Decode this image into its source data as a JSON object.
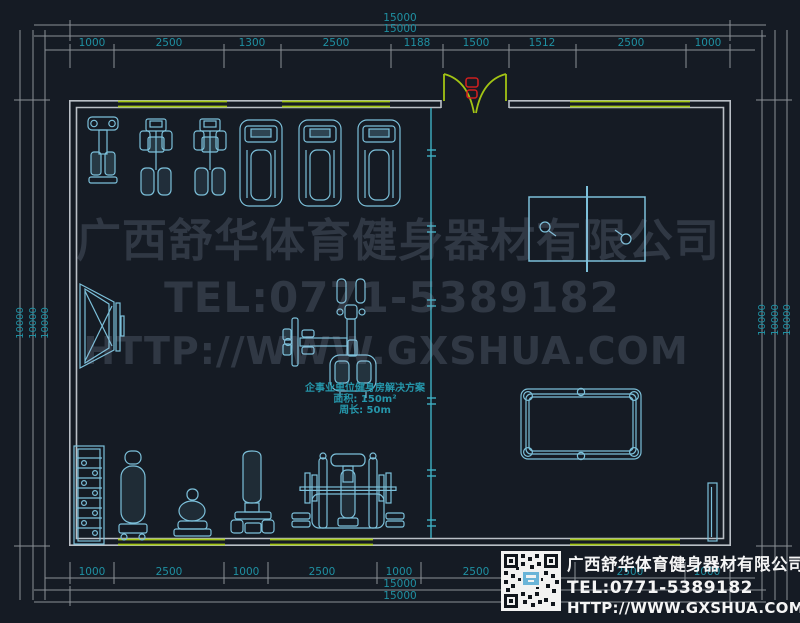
{
  "watermark": {
    "company": "广西舒华体育健身器材有限公司",
    "tel": "TEL:0771-5389182",
    "url": "HTTP://WWW.GXSHUA.COM"
  },
  "plan_info": {
    "title": "企事业单位健身房解决方案",
    "area": "面积: 150m²",
    "perimeter": "周长: 50m"
  },
  "logo": {
    "company": "广西舒华体育健身器材有限公司",
    "tel": "TEL:0771-5389182",
    "url": "HTTP://WWW.GXSHUA.COM",
    "qr_icon": "qr-code"
  },
  "dims": {
    "top_total1": "15000",
    "top_total2": "15000",
    "top_segs": [
      "1000",
      "2500",
      "1300",
      "2500",
      "1188",
      "1500",
      "1512",
      "2500",
      "1000"
    ],
    "bottom_segs": [
      "1000",
      "2500",
      "1000",
      "2500",
      "1000",
      "2500",
      "2500",
      "1000"
    ],
    "bottom_total1": "15000",
    "bottom_total2": "15000",
    "left": [
      "10000",
      "10000",
      "10000"
    ],
    "right": [
      "10000",
      "10000",
      "10000"
    ]
  },
  "colors": {
    "background": "#151b24",
    "wall": "#b9bfc6",
    "window": "#a2c414",
    "door_leaf": "#a2c414",
    "door_handle": "#cc1f1f",
    "equipment": "#7cc0da",
    "dimension_text": "#1f90a2",
    "dimension_line": "#8a9096",
    "partition": "#3fb0c4",
    "watermark_text": "#39424f",
    "logo_text": "#f5f5f5",
    "plan_text": "#2596aa"
  }
}
